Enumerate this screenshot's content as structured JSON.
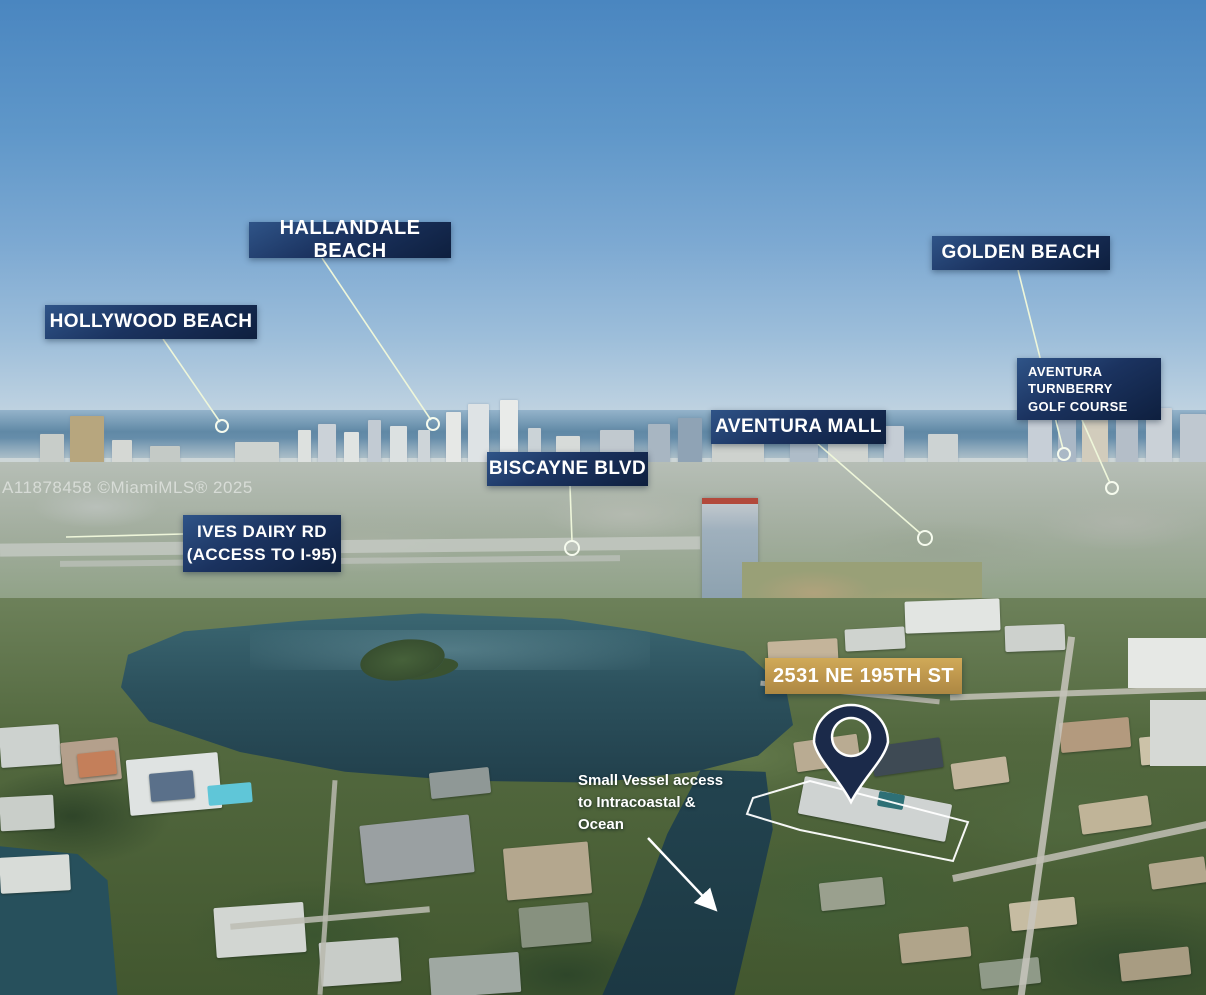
{
  "watermark": {
    "text": "A11878458 ©MiamiMLS® 2025"
  },
  "callouts": {
    "hollywood_beach": {
      "label": "HOLLYWOOD BEACH"
    },
    "hallandale_beach": {
      "label": "HALLANDALE BEACH"
    },
    "golden_beach": {
      "label": "GOLDEN BEACH"
    },
    "aventura_turnberry_golf": {
      "label": "AVENTURA\nTURNBERRY\nGOLF COURSE"
    },
    "aventura_mall": {
      "label": "AVENTURA MALL"
    },
    "biscayne_blvd": {
      "label": "BISCAYNE BLVD"
    },
    "ives_dairy_rd": {
      "label": "IVES DAIRY RD\n(ACCESS TO I-95)"
    },
    "property_address": {
      "label": "2531 NE 195TH ST"
    },
    "vessel_access_note": {
      "label": "Small Vessel access\nto Intracoastal &\nOcean"
    }
  },
  "colors": {
    "callout_bg": "#16294d",
    "callout_text": "#ffffff",
    "address_bg": "#bb944b",
    "leader_line": "#eef6da",
    "marker_circle": "#f6fbee",
    "arrow": "#ffffff",
    "property_outline": "#ffffff",
    "pin_fill": "#1b2a4a",
    "pin_stroke": "#ffffff"
  }
}
